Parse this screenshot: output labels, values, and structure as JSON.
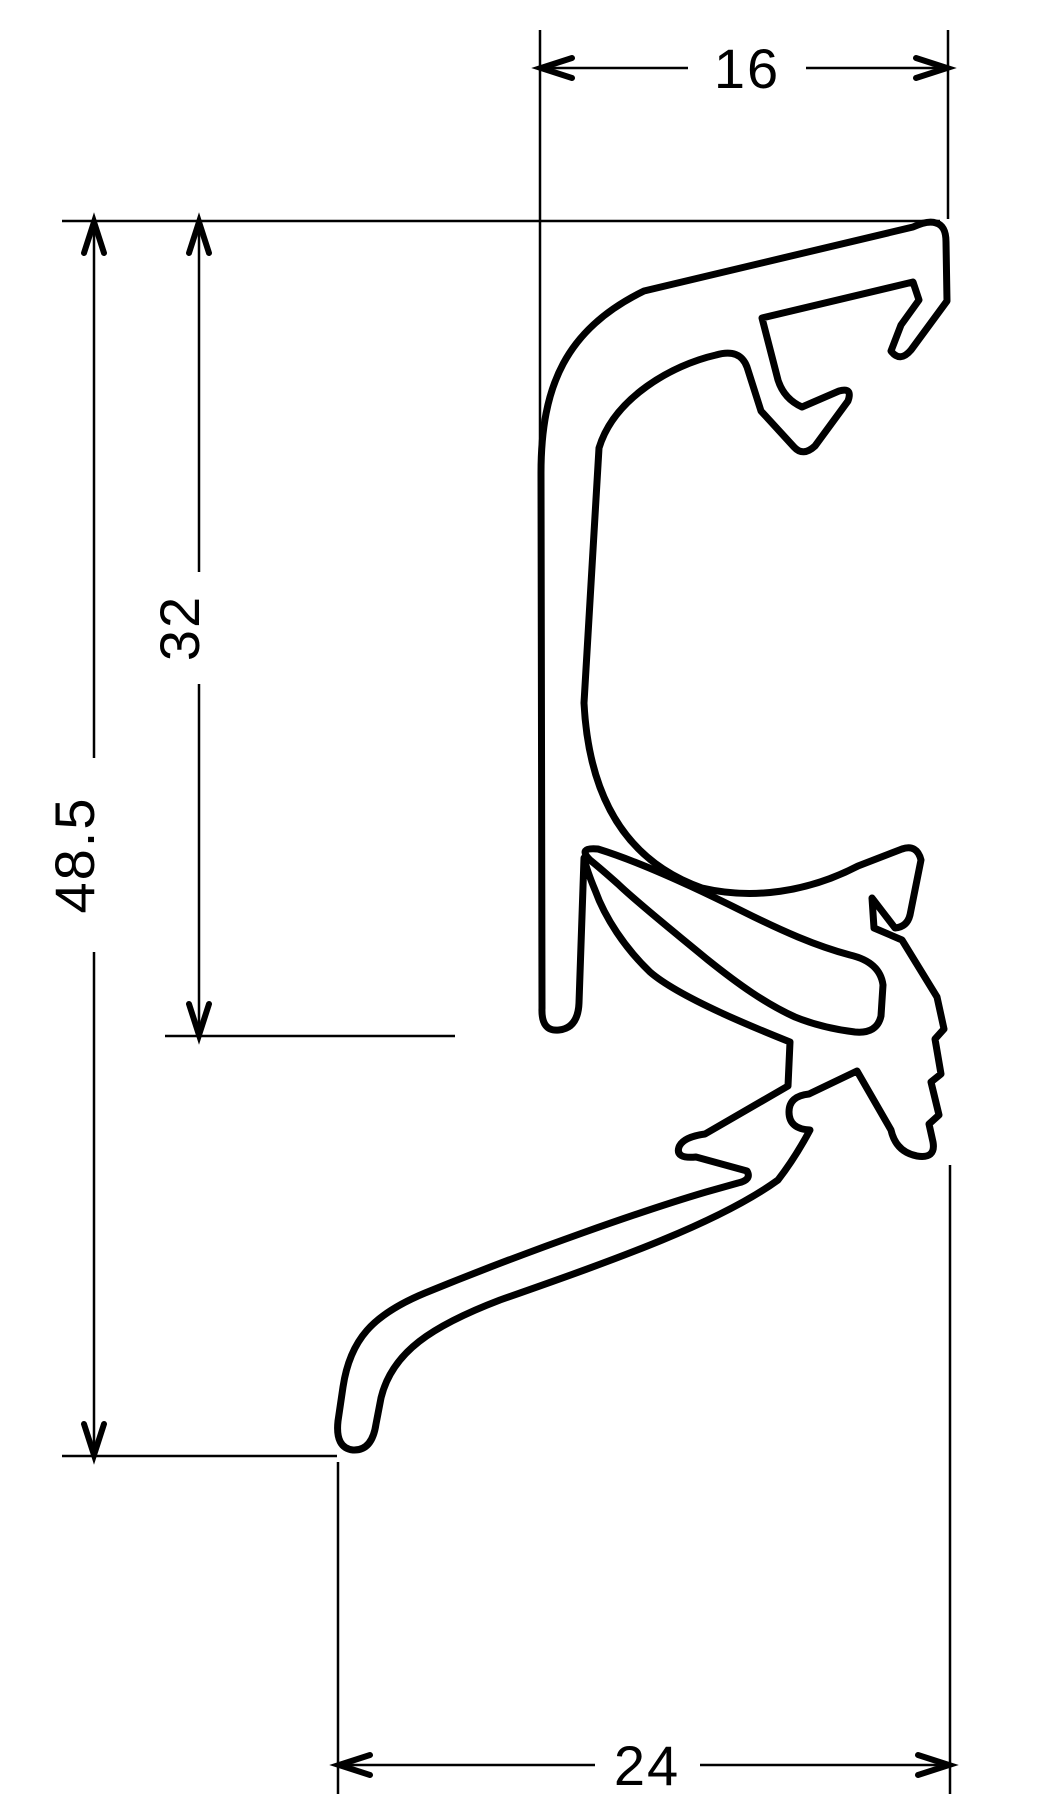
{
  "drawing": {
    "type": "technical-cross-section",
    "description": "CAD cross-section drawing of an aluminium window-sill edge extrusion profile with dimension annotations",
    "line_color": "#000000",
    "background_color": "#ffffff",
    "outline_path": "M 936 223 C 943 225 946 231 946 242 L 947 301 L 911 350 Q 900 363 891 351 L 901 325 L 919 300 L 913 282 L 762 318 L 778 380 Q 784 399 802 407 L 839 391 Q 853 387 848 401 L 815 446 Q 803 457 794 447 L 761 411 L 747 367 Q 740 348 716 355 C 672 365 614 398 599 448 L 584 703 C 589 800 628 862 702 888 C 753 900 808 892 858 866 L 902 849 Q 917 844 921 860 L 910 915 Q 907 927 895 928 L 872 898 L 874 928 L 902 940 L 937 997 L 944 1029 L 935 1039 L 941 1074 L 931 1082 L 939 1115 L 929 1124 L 933 1142 Q 936 1159 917 1156 Q 896 1152 891 1130 L 857 1071 L 809 1094 Q 789 1096 789 1112 Q 789 1129 810 1130 Q 795 1158 778 1180 C 720 1222 620 1258 500 1300 C 432 1326 392 1352 381 1398 L 376 1424 Q 372 1451 353 1450 Q 335 1448 338 1421 L 343 1387 C 350 1340 372 1315 425 1293 C 530 1250 645 1210 706 1192 L 738 1183 Q 752 1180 747 1171 L 696 1157 Q 675 1159 679 1147 Q 683 1137 705 1134 L 788 1086 L 790 1042 C 760 1030 680 998 650 972 C 625 948 605 918 595 890 Q 587 871 584 858 L 579 1003 Q 578 1028 559 1030 Q 541 1032 542 1008 L 541 473 C 541 386 566 329 644 291 L 913 227 Q 928 220 936 223 Z",
    "cavity_path": "M 598 849 C 640 862 692 886 742 911 C 782 931 816 946 850 955 Q 880 962 883 985 L 881 1016 Q 877 1034 855 1032 Q 822 1028 795 1017 C 766 1004 738 984 708 960 C 673 931 640 905 618 884 Q 600 868 590 860 Q 577 847 598 849 Z"
  },
  "dimensions": {
    "top_width": {
      "label": "16",
      "orientation": "horizontal"
    },
    "inner_height": {
      "label": "32",
      "orientation": "vertical"
    },
    "total_height": {
      "label": "48.5",
      "orientation": "vertical"
    },
    "bottom_width": {
      "label": "24",
      "orientation": "horizontal"
    }
  }
}
